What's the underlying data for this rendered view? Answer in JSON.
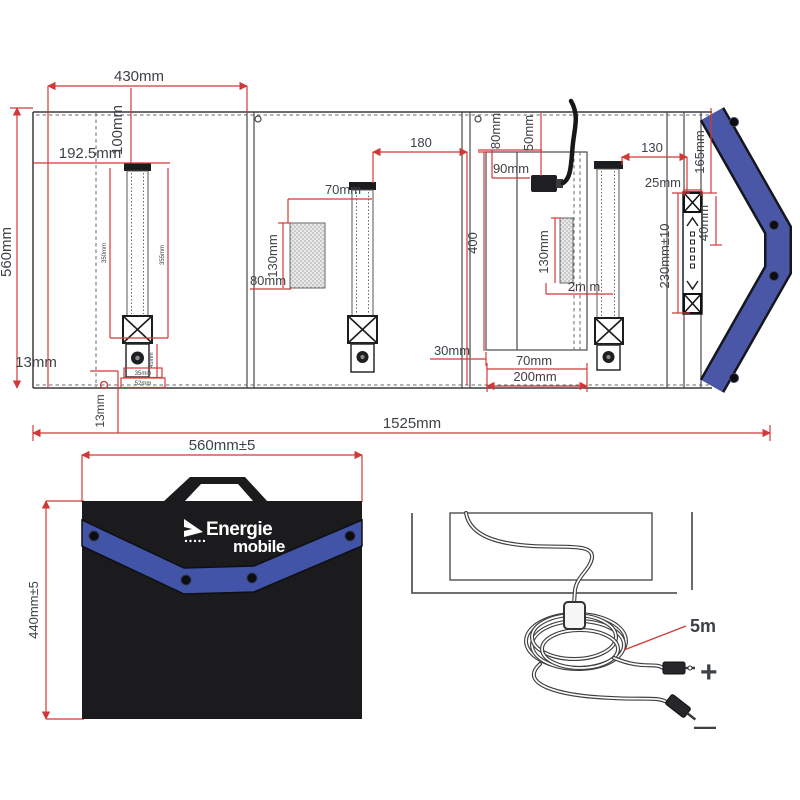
{
  "unfolded": {
    "dims": {
      "panel_width": "430mm",
      "half_width": "192.5mm",
      "strap_top_offset": "100mm",
      "panel_height": "560mm",
      "grommet_offset": "13mm",
      "grommet_offset_v": "13mm",
      "total_width": "1525mm",
      "strap_len_left": "350mm",
      "strap_len_right": "355mm",
      "snap_len": "45mm",
      "strap_width": "35mm",
      "strap_base": "52mm",
      "strap_to_edge": "180",
      "pocket_to_strap": "70mm",
      "pocket_height": "130mm",
      "pocket_bottom": "80mm",
      "cable_offset_h": "80mm",
      "cable_offset_v": "50mm",
      "connector_offset": "90mm",
      "frame_height": "400",
      "pocket3_height": "130mm",
      "pocket3_gap": "2m m",
      "bottom_margin": "30mm",
      "bottom_pocket": "70mm",
      "bottom_frame": "200mm",
      "edge_to_strap": "130",
      "edge_width": "25mm",
      "edge_top_offset": "165mm",
      "edge_strap_len": "230mm±10",
      "edge_buckle": "40mm"
    }
  },
  "folded": {
    "width_label": "560mm±5",
    "height_label": "440mm±5",
    "brand_line1": "Energie",
    "brand_line2": "mobile"
  },
  "cable": {
    "length_label": "5m",
    "plus_symbol": "+",
    "minus_symbol": "—"
  },
  "colors": {
    "dimension_red": "#d13838",
    "line_dark": "#3b3b3e",
    "flap_blue": "#4a57a7",
    "bag_black": "#1b1b1e",
    "band_blue": "#4254a8"
  }
}
